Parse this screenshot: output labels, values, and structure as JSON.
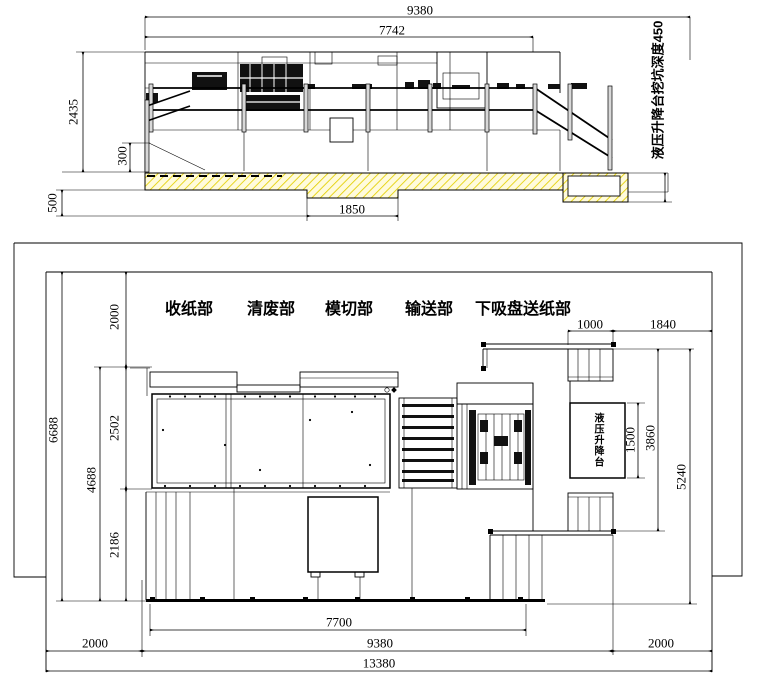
{
  "elevation": {
    "dim_total_width": "9380",
    "dim_machine_width": "7742",
    "dim_machine_height": "2435",
    "dim_base_height": "300",
    "dim_foundation_depth": "500",
    "dim_pit_width": "1850",
    "pit_note": "液压升降台挖坑深度450"
  },
  "plan": {
    "section_labels": [
      "收纸部",
      "清废部",
      "模切部",
      "输送部",
      "下吸盘送纸部"
    ],
    "platform_label": "液压升降台",
    "dim_top_left": "2000",
    "dim_upper_depth": "2502",
    "dim_lower_depth": "2186",
    "dim_inner_depth": "4688",
    "dim_total_depth": "6688",
    "dim_stair_width": "1000",
    "dim_right_gap": "1840",
    "dim_platform_length": "1500",
    "dim_platform_zone": "3860",
    "dim_right_depth": "5240",
    "dim_machine_length": "7700",
    "dim_layout_length": "9380",
    "dim_total_length": "13380",
    "dim_left_clearance": "2000",
    "dim_right_clearance": "2000"
  },
  "colors": {
    "line": "#000000",
    "hatch_line": "#e3cf00",
    "hatch_bg": "#fffbdc"
  }
}
